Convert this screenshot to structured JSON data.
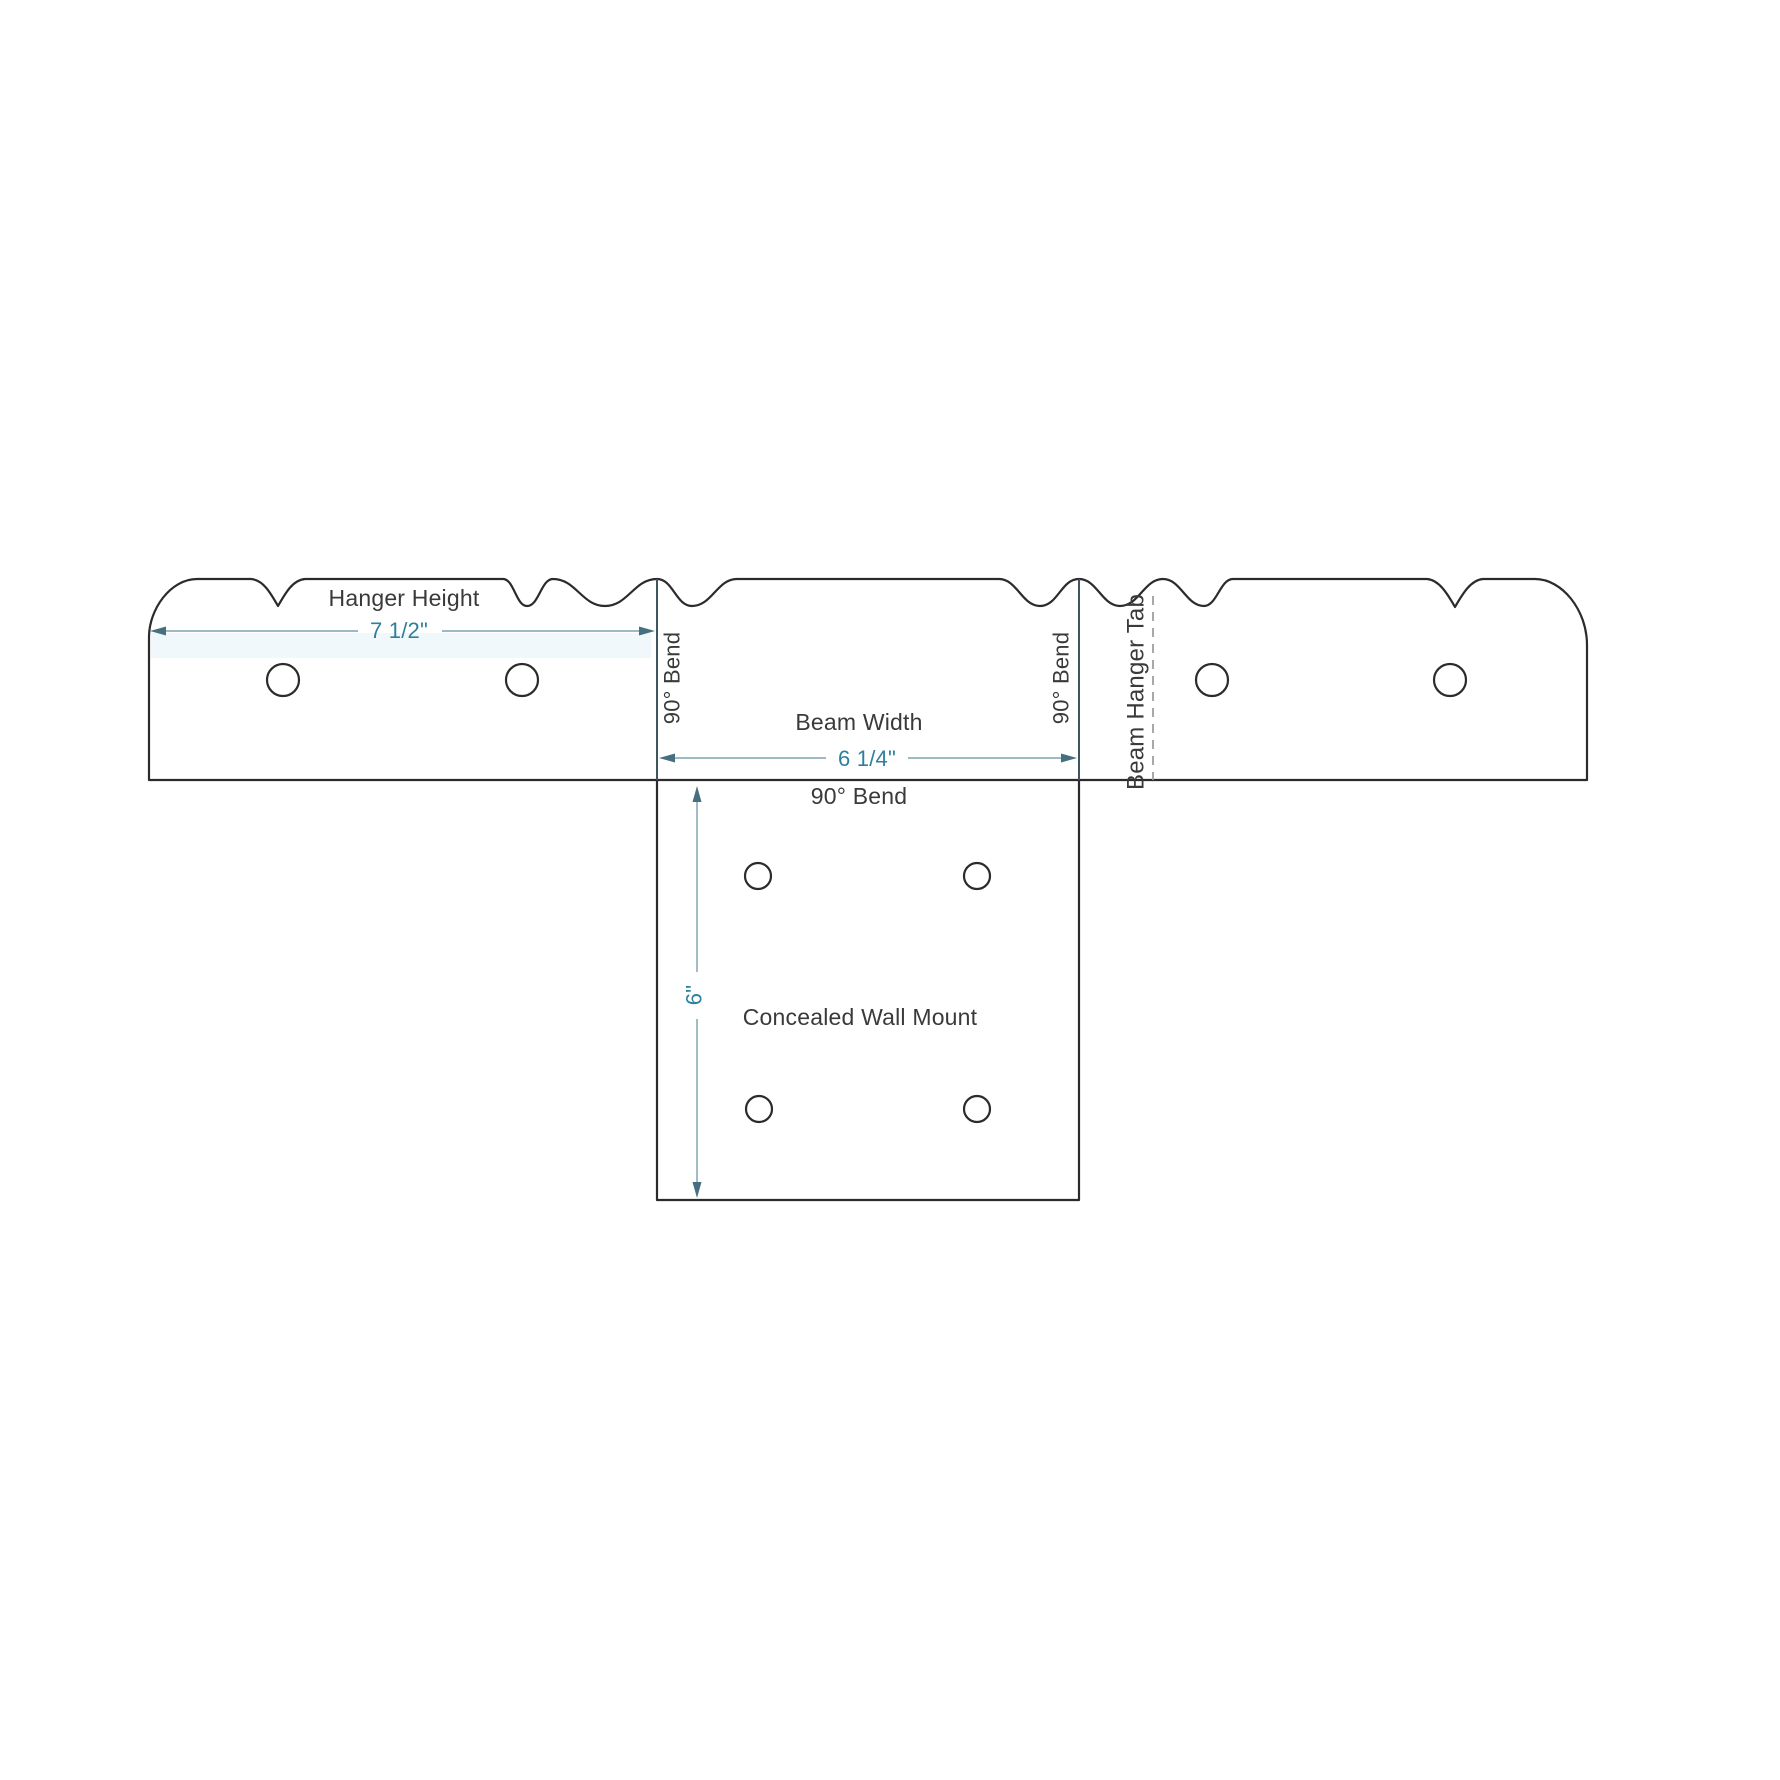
{
  "diagram": {
    "product": "Concealed Wall Mount",
    "labels": {
      "hanger_height": "Hanger Height",
      "beam_width": "Beam Width",
      "bend_left": "90° Bend",
      "bend_right": "90° Bend",
      "bend_bottom": "90° Bend",
      "beam_hanger_tab": "Beam Hanger Tab",
      "wall_mount": "Concealed Wall Mount"
    },
    "dimensions": {
      "hanger_height": "7 1/2\"",
      "beam_width": "6 1/4\"",
      "mount_height": "6\""
    },
    "colors": {
      "background": "#ffffff",
      "outline": "#2b2b2b",
      "bend_line": "#3f565f",
      "fold_line": "#9a9a9a",
      "dimension_line": "#8fb0bc",
      "dimension_arrow": "#46707f",
      "dimension_text": "#2e7f9e",
      "label_text": "#3a3a3a"
    }
  }
}
